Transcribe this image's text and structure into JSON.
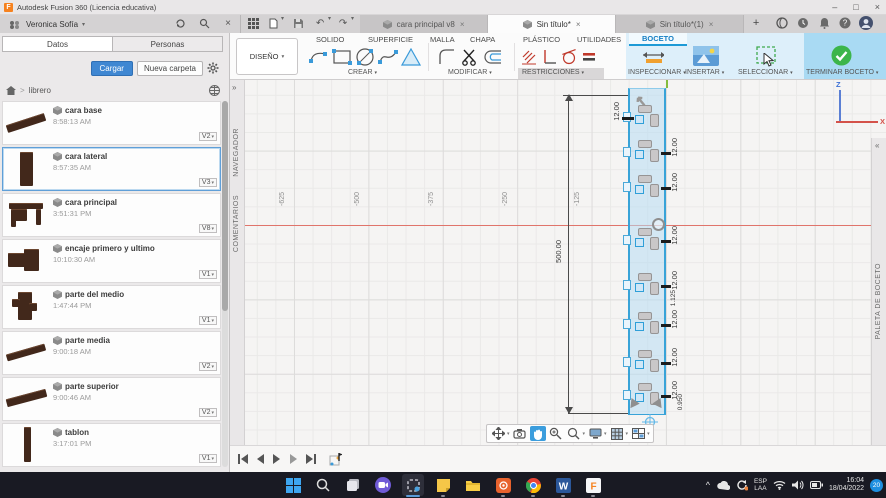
{
  "window": {
    "title": "Autodesk Fusion 360 (Licencia educativa)"
  },
  "icons": {
    "caret_down": "▾",
    "close": "×",
    "minimize": "–",
    "maximize": "□",
    "plus": "+",
    "question": "?",
    "undo": "↶",
    "redo": "↷",
    "expand_right": "»",
    "expand_left": "«",
    "breadcrumb_sep": ">",
    "chevron_up": "^"
  },
  "header": {
    "user": "Veronica Sofía",
    "tabs": [
      {
        "label": "cara principal v8"
      },
      {
        "label": "Sin título*"
      },
      {
        "label": "Sin título*(1)"
      }
    ]
  },
  "ribbon": {
    "design": "DISEÑO",
    "tabs": [
      "SOLIDO",
      "SUPERFICIE",
      "MALLA",
      "CHAPA",
      "PLÁSTICO",
      "UTILIDADES",
      "BOCETO"
    ],
    "groups": {
      "crear": "CREAR",
      "modificar": "MODIFICAR",
      "restricciones": "RESTRICCIONES",
      "inspeccionar": "INSPECCIONAR",
      "insertar": "INSERTAR",
      "seleccionar": "SELECCIONAR",
      "terminar": "TERMINAR BOCETO"
    }
  },
  "sidebar": {
    "tab_datos": "Datos",
    "tab_personas": "Personas",
    "cargar": "Cargar",
    "nueva_carpeta": "Nueva carpeta",
    "breadcrumb": "librero",
    "items": [
      {
        "name": "cara base",
        "time": "8:58:13 AM",
        "version": "V2"
      },
      {
        "name": "cara lateral",
        "time": "8:57:35 AM",
        "version": "V3"
      },
      {
        "name": "cara principal",
        "time": "3:51:31 PM",
        "version": "V8"
      },
      {
        "name": "encaje primero y ultimo",
        "time": "10:10:30 AM",
        "version": "V1"
      },
      {
        "name": "parte del medio",
        "time": "1:47:44 PM",
        "version": "V1"
      },
      {
        "name": "parte media",
        "time": "9:00:18 AM",
        "version": "V2"
      },
      {
        "name": "parte superior",
        "time": "9:00:46 AM",
        "version": "V2"
      },
      {
        "name": "tablon",
        "time": "3:17:01 PM",
        "version": "V1"
      }
    ]
  },
  "canvas": {
    "panels": {
      "navegador": "NAVEGADOR",
      "comentarios": "COMENTARIOS",
      "paleta": "PALETA DE BOCETO"
    },
    "axis_labels": [
      "-625",
      "-500",
      "-375",
      "-250",
      "-125"
    ],
    "viewcube": {
      "face": "FRONTAL",
      "axis_z": "Z",
      "axis_x": "X"
    },
    "dims": {
      "height": "500.00",
      "notch_top": "12.00",
      "notches": [
        "12.00",
        "12.00",
        "12.00",
        "12.00",
        "12.00",
        "12.00",
        "12.00"
      ],
      "gap": "1.125",
      "bottom": "0.950"
    }
  },
  "taskbar": {
    "word_glyph": "W",
    "fusion_glyph": "F",
    "lang1": "ESP",
    "lang2": "LAA",
    "time": "16:04",
    "date": "18/04/2022",
    "badge": "20"
  }
}
